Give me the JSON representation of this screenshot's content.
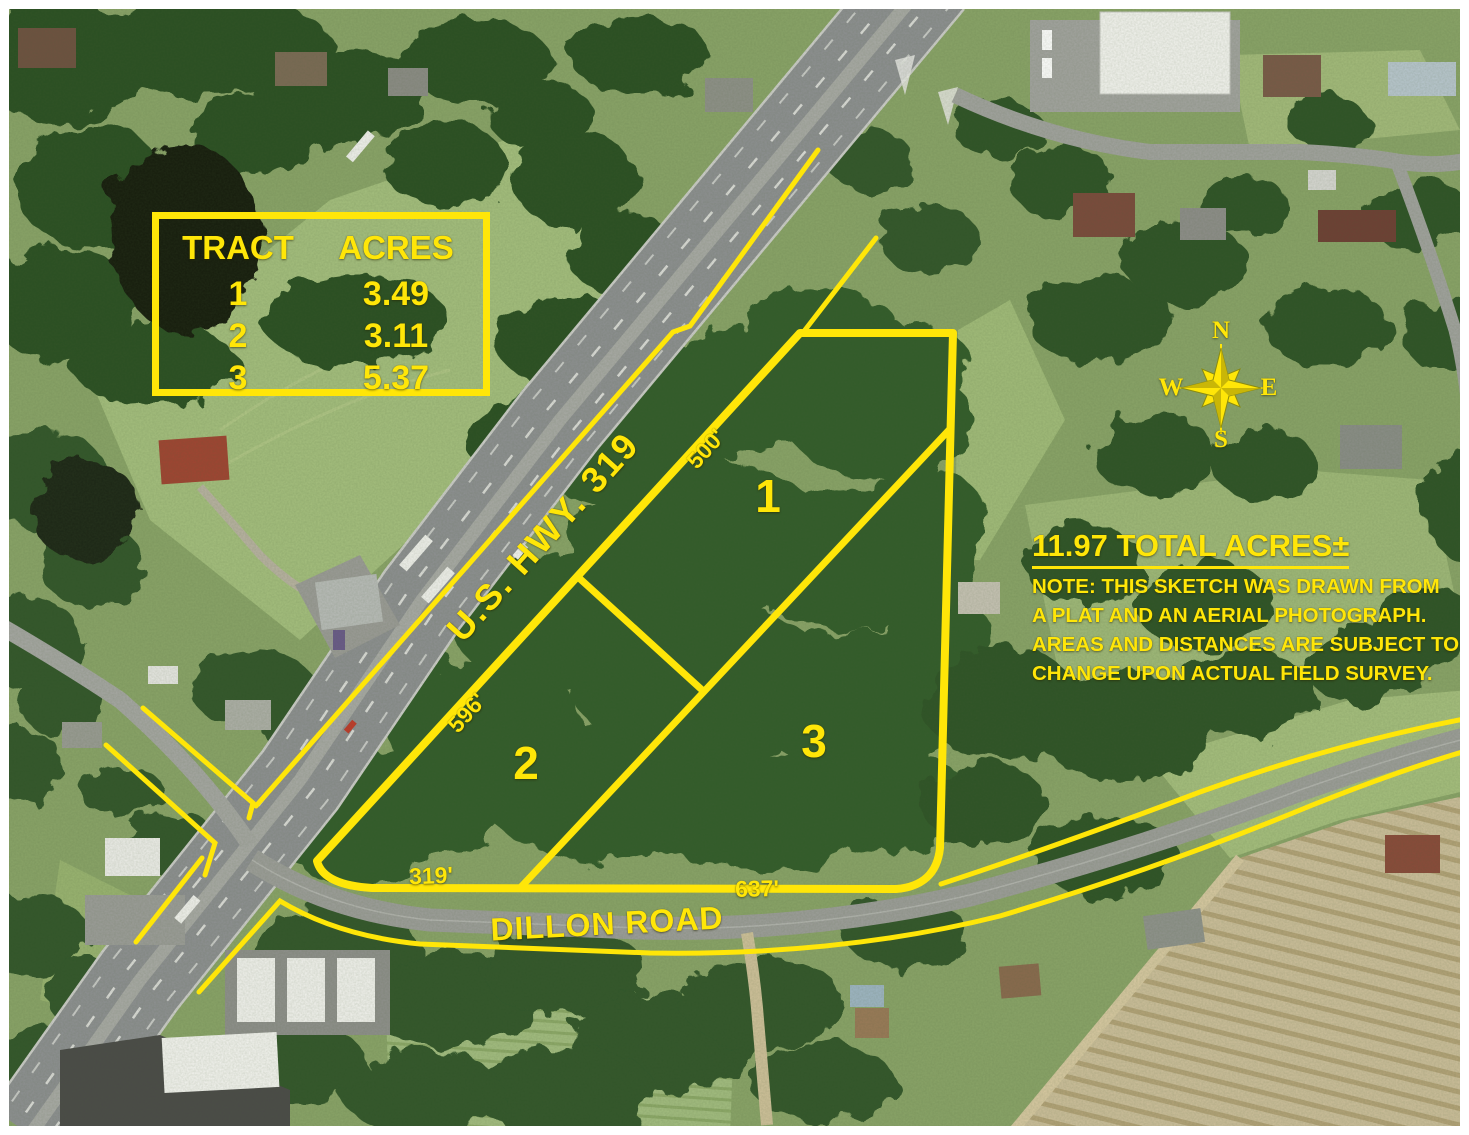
{
  "tract_table": {
    "header": {
      "tract": "TRACT",
      "acres": "ACRES"
    },
    "rows": [
      {
        "tract": "1",
        "acres": "3.49"
      },
      {
        "tract": "2",
        "acres": "3.11"
      },
      {
        "tract": "3",
        "acres": "5.37"
      }
    ]
  },
  "summary": {
    "total": "11.97 TOTAL ACRES±",
    "note_lines": [
      "NOTE: THIS SKETCH WAS DRAWN FROM",
      "A PLAT AND AN AERIAL PHOTOGRAPH.",
      "AREAS AND DISTANCES ARE SUBJECT TO",
      "CHANGE UPON ACTUAL FIELD SURVEY."
    ]
  },
  "roads": {
    "highway": "U.S. HWY. 319",
    "dillon": "DILLON ROAD"
  },
  "frontage_labels": {
    "hwy_tract1": "500'",
    "hwy_tract2": "596'",
    "dillon_tract2": "319'",
    "dillon_tract3": "637'"
  },
  "tract_markers": {
    "t1": "1",
    "t2": "2",
    "t3": "3"
  },
  "compass": {
    "north": "N",
    "south": "S",
    "east": "E",
    "west": "W"
  },
  "colors": {
    "annotation_yellow": "#ffe608",
    "asphalt_gray": "#8e9092",
    "tree_canopy_green": "#2f5527",
    "pasture_green": "#a5bf7e",
    "plowed_field_tan": "#cdbf9b"
  }
}
